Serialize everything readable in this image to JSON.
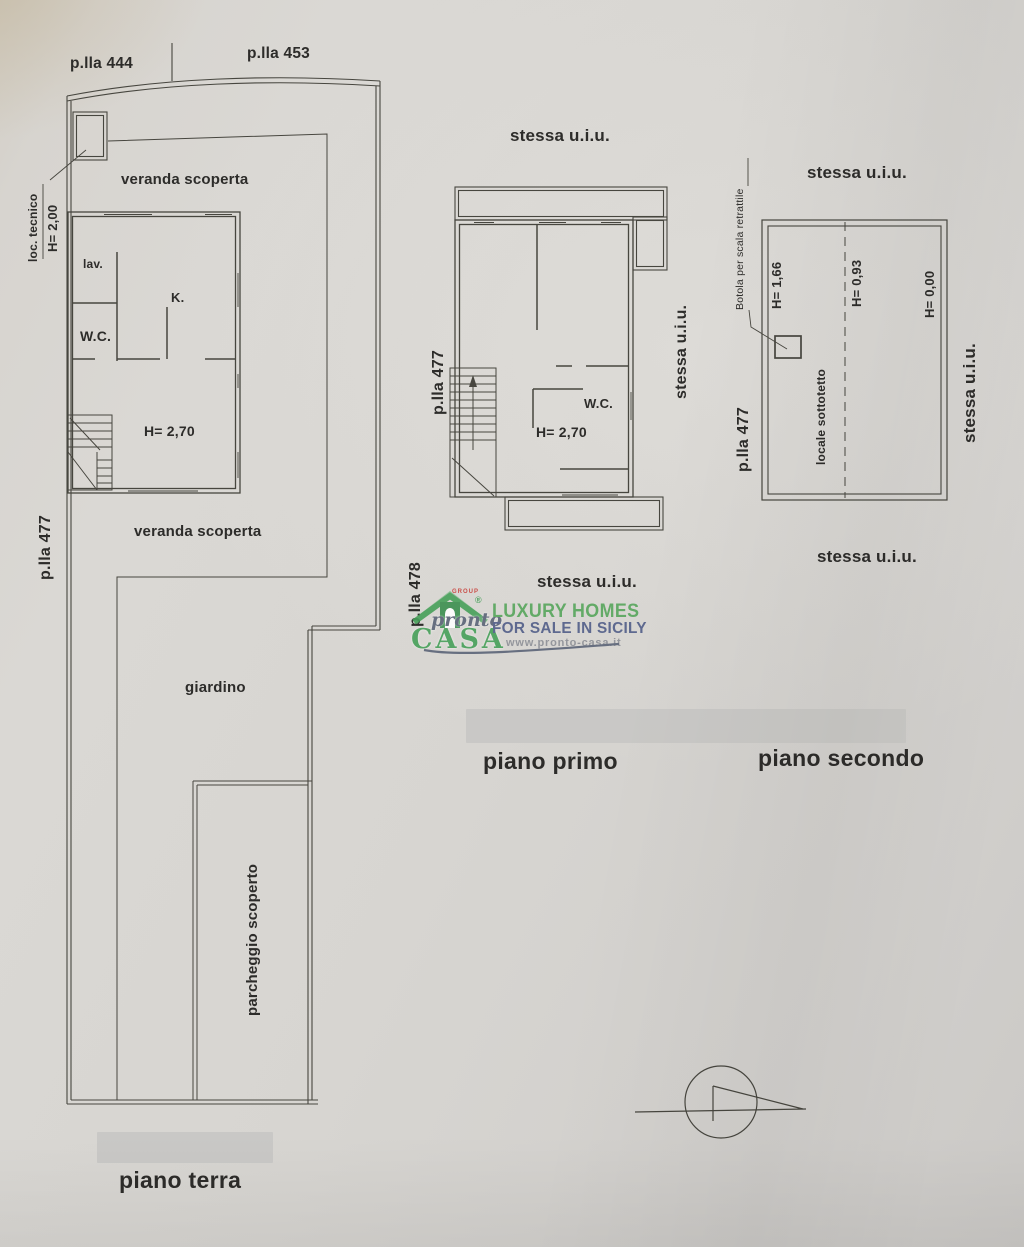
{
  "ground_floor": {
    "title": "piano terra",
    "parcel_top_left": "p.lla 444",
    "parcel_top_right": "p.lla 453",
    "parcel_left": "p.lla 477",
    "loc_tecnico_label": "loc. tecnico",
    "loc_tecnico_height": "H= 2,00",
    "veranda_top": "veranda scoperta",
    "veranda_bottom": "veranda scoperta",
    "room_lav": "lav.",
    "room_kitchen": "K.",
    "room_wc": "W.C.",
    "room_height": "H= 2,70",
    "garden": "giardino",
    "parking": "parcheggio  scoperto"
  },
  "first_floor": {
    "title": "piano primo",
    "same_unit_top": "stessa u.i.u.",
    "same_unit_right": "stessa u.i.u.",
    "same_unit_bottom": "stessa u.i.u.",
    "parcel_left": "p.lla 477",
    "parcel_bottom": "p.lla 478",
    "room_wc": "W.C.",
    "room_height": "H= 2,70"
  },
  "second_floor": {
    "title": "piano secondo",
    "same_unit_top": "stessa u.i.u.",
    "same_unit_right": "stessa u.i.u.",
    "same_unit_bottom": "stessa u.i.u.",
    "parcel_left": "p.lla 477",
    "hatch_note": "Botola per scala retrattile",
    "height_left": "H= 1,66",
    "height_mid": "H= 0,93",
    "height_right": "H= 0,00",
    "room_attic": "locale sottotetto"
  },
  "watermark": {
    "group": "GROUP",
    "brand_line1": "pronto",
    "brand_line2": "CASA",
    "registered": "®",
    "tagline1": "LUXURY HOMES",
    "tagline2": "FOR SALE IN SICILY",
    "website": "www.pronto-casa.it",
    "colors": {
      "green": "#47a05a",
      "red": "#c9403a",
      "slate": "#515e88",
      "grey": "#8d9097"
    }
  },
  "paper": {
    "background": "#d7d5d1",
    "line_color": "#47463f"
  }
}
